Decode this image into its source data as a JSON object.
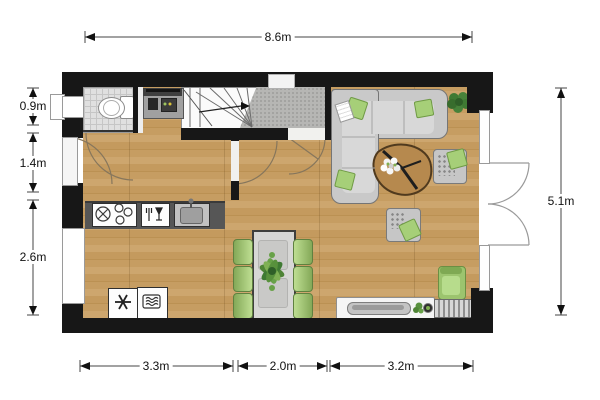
{
  "type": "floor-plan",
  "dims": {
    "top": "8.6m",
    "right": "5.1m",
    "left": [
      "0.9m",
      "1.4m",
      "2.6m"
    ],
    "bottom": [
      "3.3m",
      "2.0m",
      "3.2m"
    ]
  },
  "colors": {
    "wall": "#171717",
    "wood_floor": "#c79e63",
    "tile_floor": "#e0e0e0",
    "entry_floor": "#b6b6b4",
    "kitchen_counter": "#565656",
    "sofa_gray": "#c9c9c9",
    "accent_green": "#a6cf78",
    "table_gray": "#d7d7d5"
  },
  "icons": [
    "toilet-icon",
    "coffee-machine-icon",
    "stairs-icon",
    "up-arrow-icon",
    "cooktop-icon",
    "dishwasher-icon",
    "sink-icon",
    "freezer-icon",
    "oven-icon",
    "dining-table-icon",
    "dining-chair-icon",
    "plant-icon",
    "corner-sofa-icon",
    "coffee-table-icon",
    "armchair-icon",
    "lounge-chair-icon",
    "side-chair-icon",
    "sideboard-icon",
    "radiator-icon",
    "door-swing-icon",
    "window-icon",
    "front-door-icon"
  ]
}
